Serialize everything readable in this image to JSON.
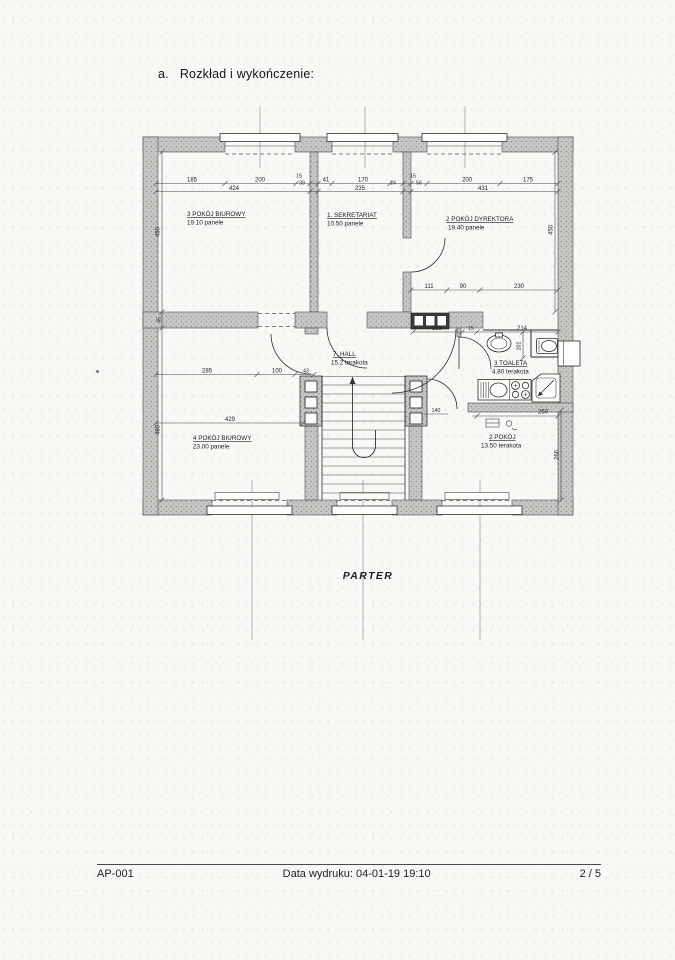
{
  "page": {
    "heading": {
      "prefix": "a.",
      "text": "Rozkład i wykończenie:"
    },
    "plan_title": "PARTER",
    "footer": {
      "doc_code": "AP-001",
      "printed": "Data wydruku: 04-01-19 19:10",
      "page": "2 / 5"
    }
  },
  "rooms": {
    "office3": {
      "name": "3 POKÓJ BIUROWY",
      "finish": "19.10 panele"
    },
    "sekretariat": {
      "name": "1. SEKRETARIAT",
      "finish": "10.50 panele"
    },
    "dyrektor": {
      "name": "2 POKÓJ DYREKTORA",
      "finish": "19.40 panele"
    },
    "hall": {
      "name": "7. HALL",
      "finish": "15.2 terakota"
    },
    "toaleta": {
      "name": "3 TOALETA",
      "finish": "4.80 terakota"
    },
    "office4": {
      "name": "4 POKÓJ BIUROWY",
      "finish": "23.00 panele"
    },
    "pokoj2": {
      "name": "2 POKÓJ",
      "finish": "13.50 terakota"
    }
  },
  "dims": {
    "row1": [
      "185",
      "200",
      "15",
      "39",
      "41",
      "170",
      "24",
      "15",
      "56",
      "200",
      "175"
    ],
    "row2": [
      "424",
      "235",
      "431"
    ],
    "dyrektor": [
      "111",
      "90",
      "230"
    ],
    "sanitary": [
      "185",
      "15",
      "214"
    ],
    "office4_top": [
      "285",
      "100",
      "43"
    ],
    "office4_width": "429",
    "pokoj2_width": "250",
    "pokoj2_door": "140",
    "left_upper": "450",
    "left_wall": "45",
    "left_lower": "480",
    "right_upper": "450",
    "right_lower": "266",
    "toilet_niche": "202"
  },
  "colors": {
    "ink": "#1b1b1b",
    "wall_fill": "#c7c7c5",
    "paper": "#f8f8f5"
  }
}
